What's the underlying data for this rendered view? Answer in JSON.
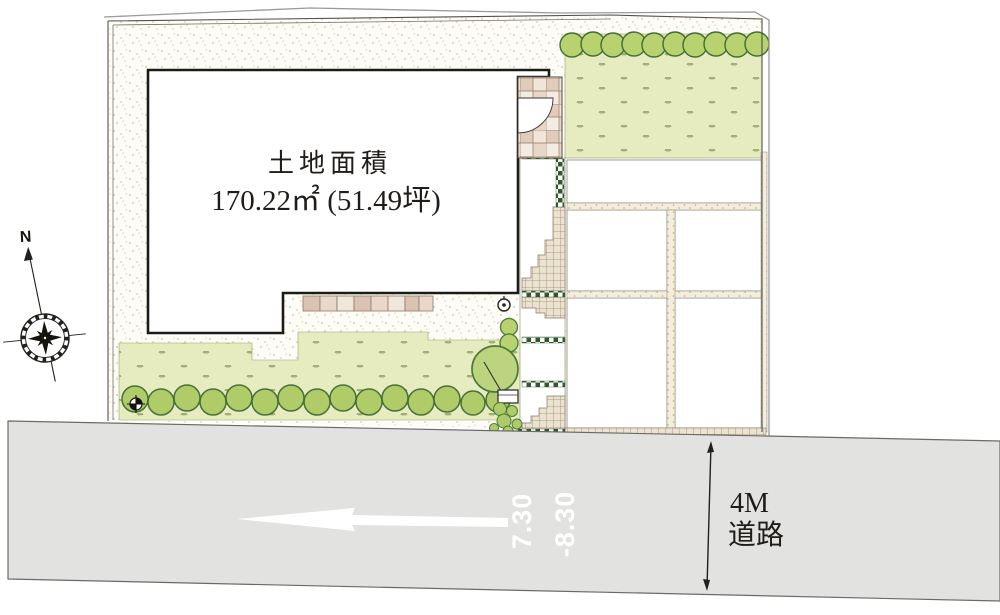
{
  "title": {
    "label": "土地面積",
    "area": "170.22㎡ (51.49坪)"
  },
  "compass": {
    "north_label": "N"
  },
  "road": {
    "width_label_line1": "4M",
    "width_label_line2": "道路",
    "elevation_a": "7.30",
    "elevation_b": "-8.30"
  },
  "colors": {
    "lawn": "#e6ecc0",
    "tree_fill": "#b7d26e",
    "tree_stroke": "#426d33",
    "road_gray": "#e2e2e1",
    "hedge_green": "#30592c",
    "tile_tan": "#e2cbba",
    "hatch_fill": "#ece2d0",
    "stipple_dot": "#b3a78f",
    "outline_dark": "#1d1b18"
  }
}
